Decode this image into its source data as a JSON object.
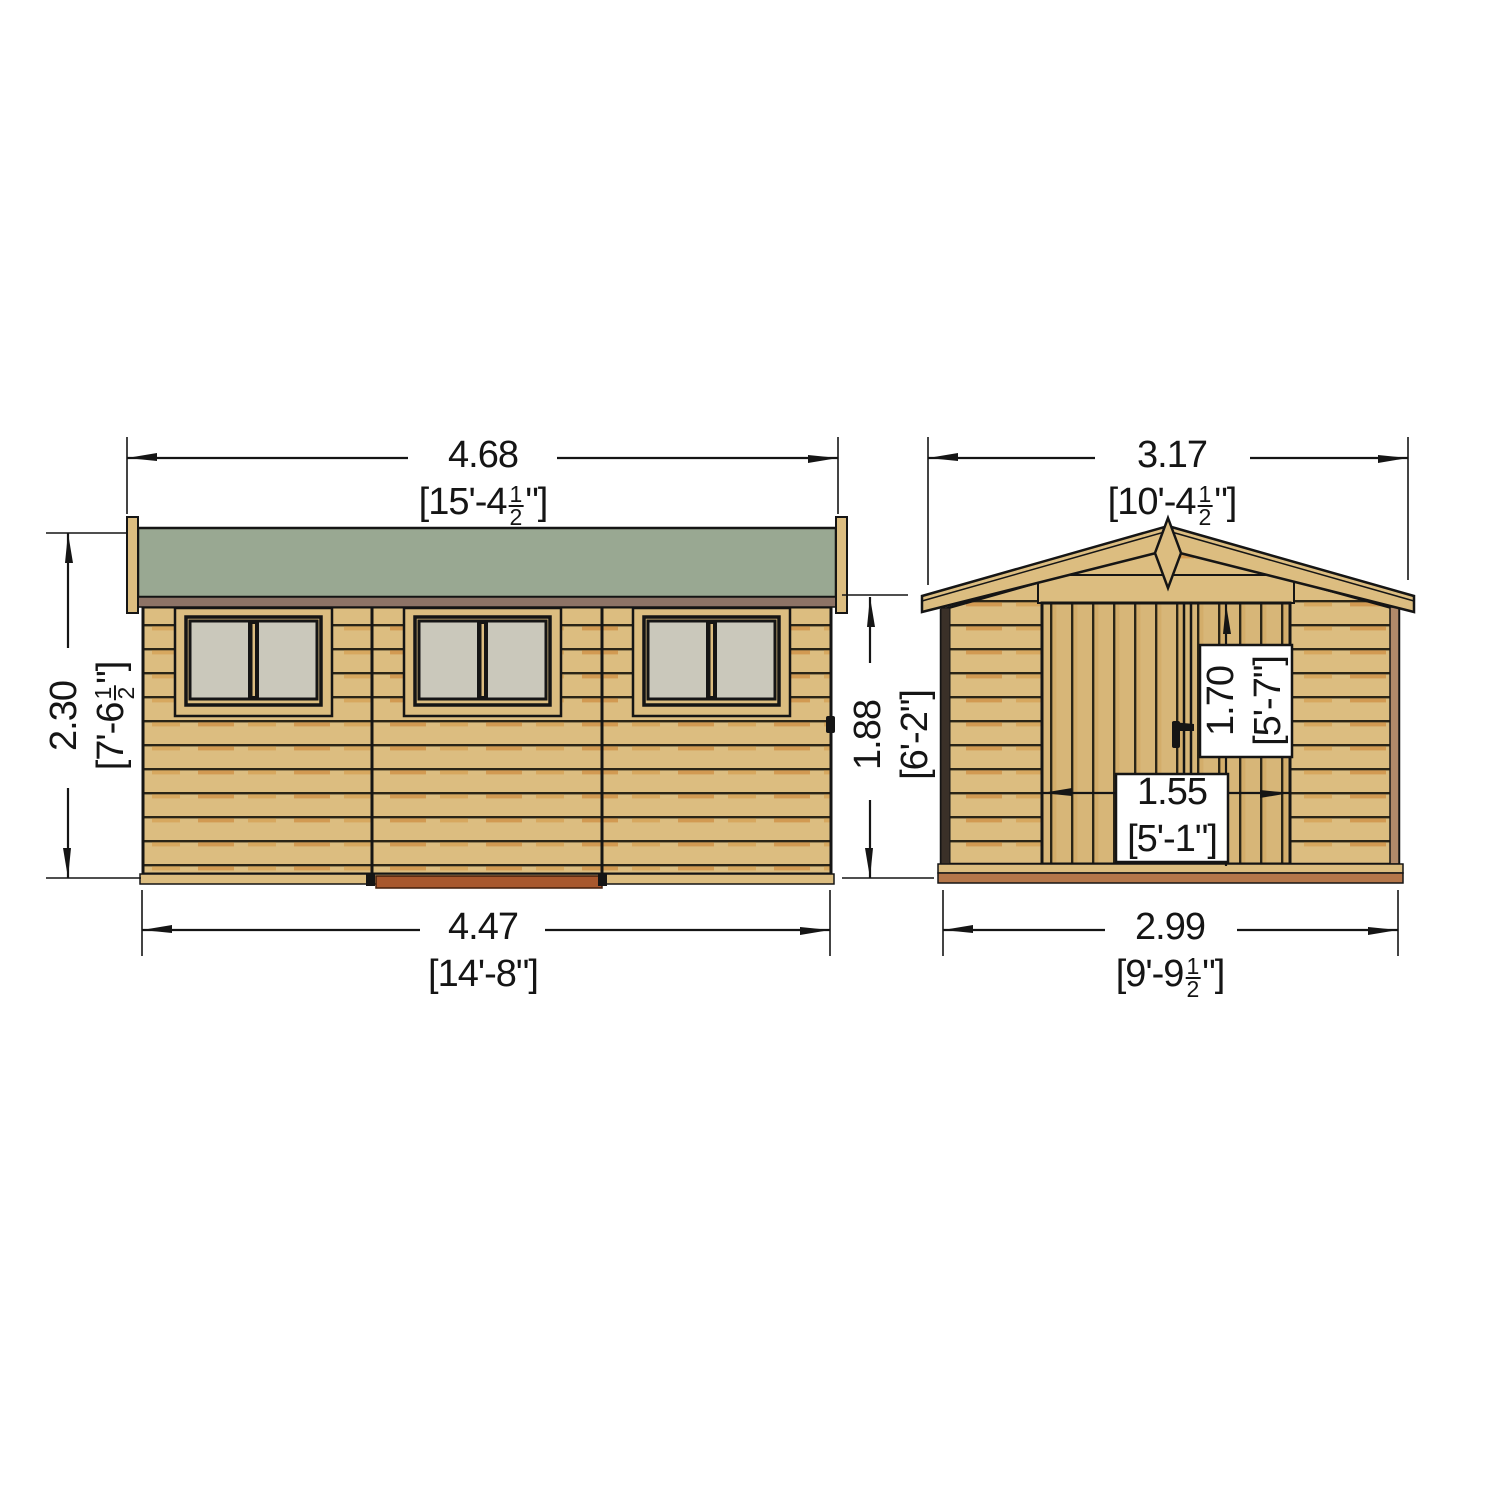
{
  "diagram": {
    "type": "shed-elevation-dimension-drawing",
    "views": {
      "side_elevation": {
        "window_count": 3,
        "roof_color": "#99a892"
      },
      "front_elevation": {
        "door_count": 2
      }
    },
    "dimensions": {
      "side_width_overall": {
        "metric": "4.68",
        "imperial_prefix": "[15'-4",
        "fraction_numerator": "1",
        "fraction_denominator": "2",
        "imperial_suffix": "\"]"
      },
      "side_height": {
        "metric": "2.30",
        "imperial_prefix": "[7'-6",
        "fraction_numerator": "1",
        "fraction_denominator": "2",
        "imperial_suffix": "\"]"
      },
      "side_width_base": {
        "metric": "4.47",
        "imperial_prefix": "[14'-8\"]",
        "fraction_numerator": "",
        "fraction_denominator": "",
        "imperial_suffix": ""
      },
      "front_width_overall": {
        "metric": "3.17",
        "imperial_prefix": "[10'-4",
        "fraction_numerator": "1",
        "fraction_denominator": "2",
        "imperial_suffix": "\"]"
      },
      "eaves_height": {
        "metric": "1.88",
        "imperial_prefix": "[6'-2\"]",
        "fraction_numerator": "",
        "fraction_denominator": "",
        "imperial_suffix": ""
      },
      "door_height": {
        "metric": "1.70",
        "imperial_prefix": "[5'-7\"]",
        "fraction_numerator": "",
        "fraction_denominator": "",
        "imperial_suffix": ""
      },
      "door_width": {
        "metric": "1.55",
        "imperial_prefix": "[5'-1\"]",
        "fraction_numerator": "",
        "fraction_denominator": "",
        "imperial_suffix": ""
      },
      "front_width_base": {
        "metric": "2.99",
        "imperial_prefix": "[9'-9",
        "fraction_numerator": "1",
        "fraction_denominator": "2",
        "imperial_suffix": "\"]"
      }
    },
    "colors": {
      "roof_green": "#99a892",
      "wood_board": "#dcbd80",
      "wood_shadow": "#d29a52",
      "door_wood": "#d7b678",
      "fascia_brown": "#8d7366",
      "corner_brown": "#b28a6a",
      "window_pane": "#cac8bb",
      "base_red": "#a8582e",
      "trim_red": "#b5774a",
      "line_black": "#151515"
    }
  }
}
